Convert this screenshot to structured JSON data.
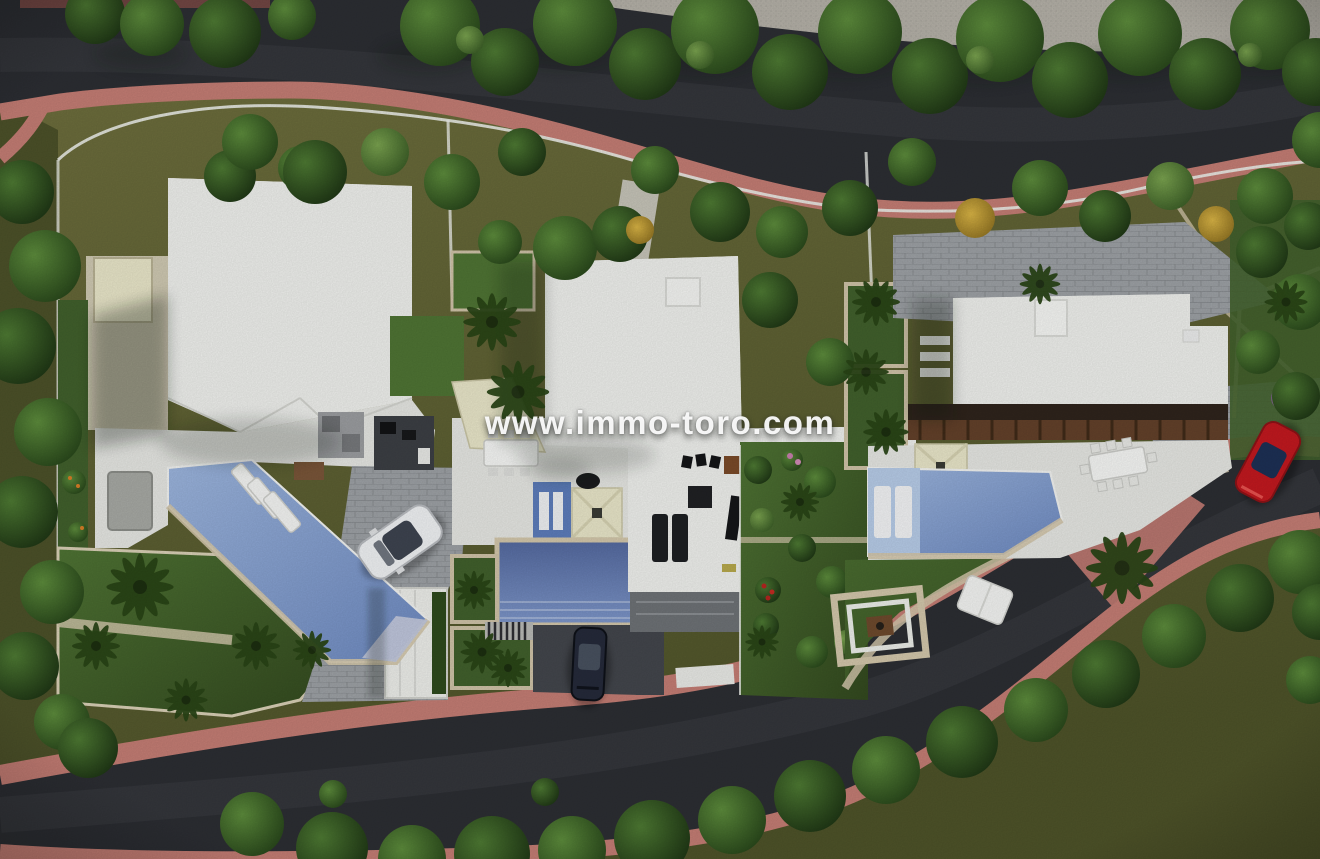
{
  "watermark": {
    "text": "www.immo-toro.com"
  },
  "palette": {
    "asphalt": "#2c2e33",
    "asphalt-worn": "#3b3e43",
    "sidewalk-pink": "#c47d74",
    "sidewalk-pink-dark": "#8f544f",
    "olive": "#6d6e44",
    "olive-dark": "#4c5129",
    "lawn": "#41602c",
    "lawn-bright": "#4f7434",
    "roof-white": "#eff0ed",
    "terrace-white": "#e6e7e3",
    "stone-beige": "#d3c7ab",
    "paver-gray": "#9da1a5",
    "courtyard-dark": "#43464c",
    "pool-blue": "#7d9cd0",
    "pool-pale": "#b7cce8",
    "pergola-brown": "#63412a",
    "canopy-cream": "#e9e6c9",
    "pavement-top": "#b5b1a8",
    "car-white": "#f0f2f4",
    "car-red": "#c2191f",
    "car-dark": "#252a3a",
    "wall-white": "#eceee9"
  }
}
